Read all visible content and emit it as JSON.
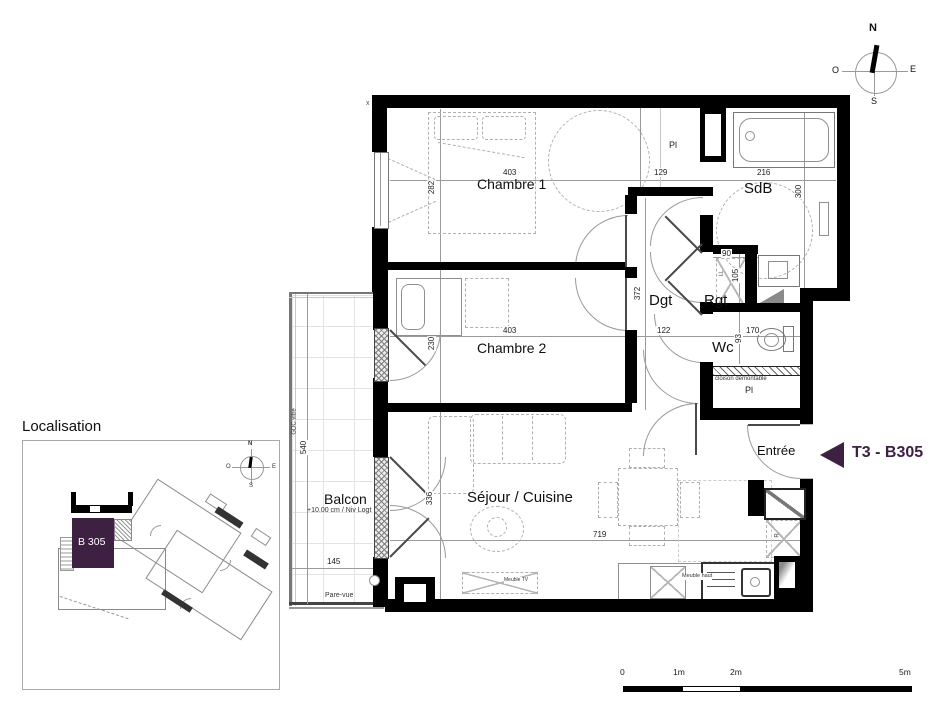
{
  "colors": {
    "accent": "#3e2043",
    "walls": "#000000"
  },
  "plan": {
    "unit_tag": "T3 - B305",
    "corner_mark": "x",
    "rooms": {
      "chambre1": {
        "name": "Chambre 1",
        "w": "403",
        "h": "282"
      },
      "chambre2": {
        "name": "Chambre 2",
        "w": "403",
        "h": "230"
      },
      "sdb": {
        "name": "SdB",
        "w": "216",
        "h": "300"
      },
      "dgt": {
        "name": "Dgt",
        "w": "122",
        "h": "372"
      },
      "rgt": {
        "name": "Rgt",
        "w": "90",
        "h": "105"
      },
      "wc": {
        "name": "Wc",
        "w": "170",
        "h": "93"
      },
      "sejour": {
        "name": "Séjour / Cuisine",
        "w": "719",
        "h": "336"
      },
      "entree": {
        "name": "Entrée"
      },
      "balcon": {
        "name": "Balcon",
        "note": "+10.00 cm / Niv Logt",
        "w": "145",
        "h": "540"
      }
    },
    "closets": {
      "pl": "Pl",
      "pl_top_dim": "129",
      "cloison": "cloison demontable"
    },
    "kitchen": {
      "meuble_tv": "Meuble TV",
      "meuble_haut": "Meuble haut",
      "fridge": "R",
      "washer": "LL"
    },
    "balcony_labels": {
      "gdc_vitre": "GDC vitre",
      "pare_vue": "Pare-vue"
    },
    "compass": {
      "n": "N",
      "e": "E",
      "s": "S",
      "o": "O"
    }
  },
  "localisation": {
    "title": "Localisation",
    "unit_label": "B 305"
  },
  "scale_bar": {
    "zero": "0",
    "one": "1m",
    "two": "2m",
    "five": "5m"
  }
}
